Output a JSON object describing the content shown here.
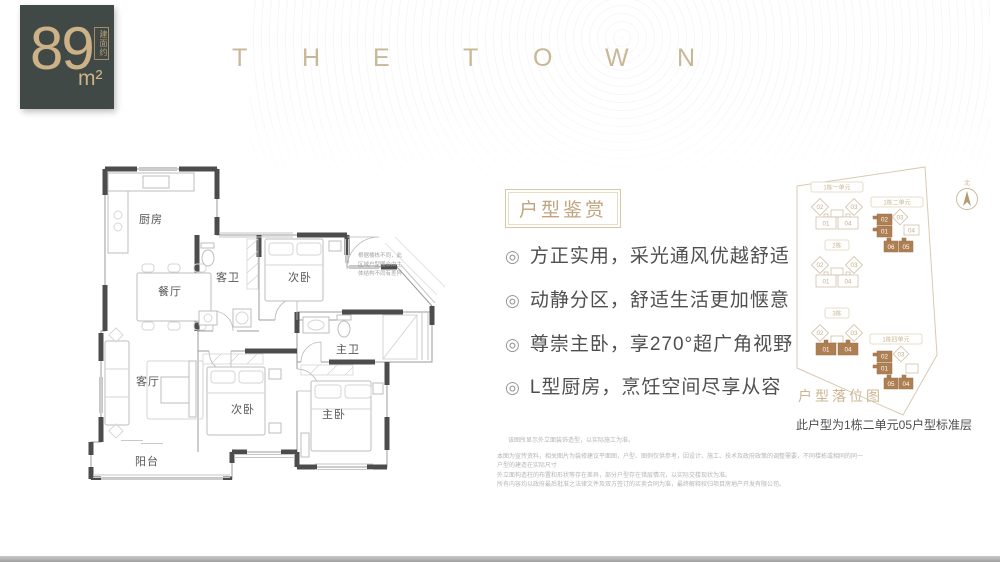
{
  "badge": {
    "value": "89",
    "unit": "m²",
    "note": "建面约"
  },
  "brand": {
    "letters": [
      "T",
      "H",
      "E",
      "T",
      "O",
      "W",
      "N"
    ]
  },
  "plan": {
    "rooms": {
      "kitchen": "厨房",
      "dining": "餐厅",
      "guest_bath": "客卫",
      "bed2": "次卧",
      "living": "客厅",
      "bed3": "次卧",
      "master_bath": "主卫",
      "master": "主卧",
      "balcony": "阳台"
    },
    "note_lines": [
      "根据楼栋不同，此",
      "区域户型图会由主",
      "体结构不同有差异"
    ]
  },
  "features": {
    "heading": "户型鉴赏",
    "bullet": "◎",
    "items": [
      "方正实用，采光通风优越舒适",
      "动静分区，舒适生活更加惬意",
      "尊崇主卧，享270°超广角视野",
      "L型厨房，烹饪空间尽享从容"
    ]
  },
  "sitemap": {
    "title": "户型落位图",
    "compass": "北",
    "caption": "此户型为1栋二单元05户型标准层",
    "colors": {
      "highlight": "#ad7f52",
      "outline": "#cfc0a8"
    },
    "buildings": [
      {
        "label": "1栋一单元",
        "u1": "02",
        "u2": "03",
        "u3": "01",
        "u4": "04"
      },
      {
        "label": "2栋",
        "u1": "02",
        "u2": "03",
        "u3": "01",
        "u4": "04"
      },
      {
        "label": "3栋",
        "u1": "02",
        "u2": "03",
        "u3": "01",
        "u4": "04"
      },
      {
        "label": "1栋二单元",
        "u1": "02",
        "u2": "01",
        "u3": "03",
        "u4": "04",
        "u5": "06",
        "u6": "05"
      },
      {
        "label": "1栋四单元",
        "u1": "02",
        "u2": "01",
        "u3": "03",
        "u5": "05",
        "u6": "04"
      }
    ]
  },
  "disclaimer": {
    "line1": "该图所显示外立面装饰造型，以实际施工为准。",
    "lines": [
      "本图为宣传资料，相关图片为装修建议平面图，户型、图例仅供参考，因设计、施工、技术及政府政策的调整需要，不同楼栋或相同的同一户型的建造在实际尺寸",
      "外立面构造柱的布置和形状等存在差异，部分户型存在错层情况，以实际交楼现状为准。",
      "所有内容均以政府最后批准之法律文件及双方签订的买卖合同为准，最终解释权归项目房地产开发有限公司。"
    ]
  },
  "colors": {
    "badge_bg": "#404946",
    "gold": "#cdb287",
    "brand": "#c8b897",
    "wall": "#4c4c4c",
    "map_tan": "#cdb593",
    "highlight": "#ad7f52"
  }
}
